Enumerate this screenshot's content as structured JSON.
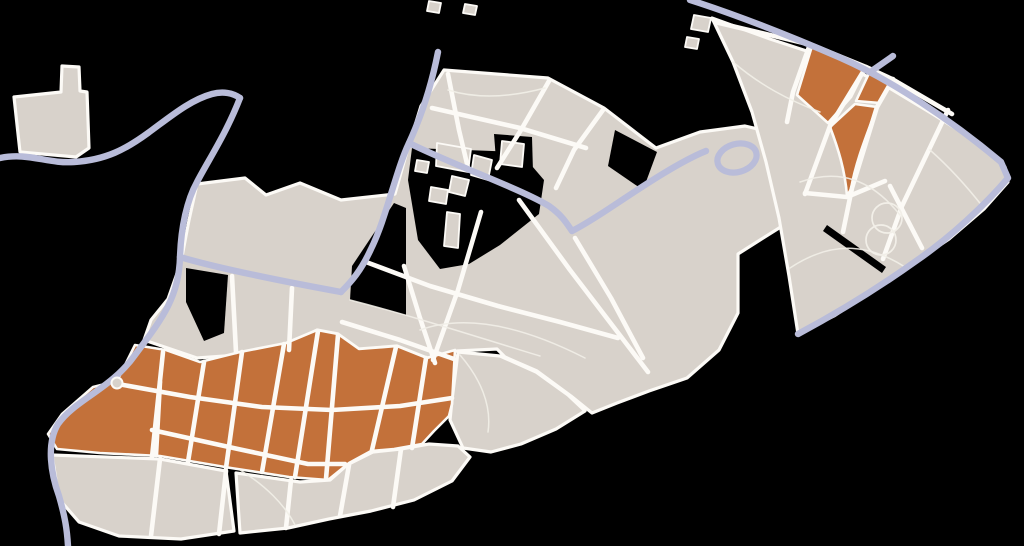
{
  "canvas": {
    "width": 1024,
    "height": 546,
    "background": "#000000"
  },
  "colors": {
    "block": "#d8d2cb",
    "street": "#fcfaf6",
    "water": "#b9bcd9",
    "highlight": "#c3713a",
    "thin_path": "#f2efe8",
    "background": "#000000"
  },
  "layers": [
    {
      "name": "city-blocks",
      "type": "paths",
      "fill": "block",
      "stroke": "street",
      "width": 3.2,
      "interactable": "false",
      "items": [
        {
          "name": "block-top-left-building",
          "d": "M14,97 L61,92 L62,66 L79,67 L80,91 L87,92 L89,148 L76,157 L20,152 Z"
        },
        {
          "name": "block-central-cluster",
          "d": "M444,70 L548,78 L604,108 L656,148 L700,132 L745,126 L788,136 L812,158 L815,186 L795,218 L760,240 L738,254 L738,313 L719,350 L687,378 L649,391 L617,403 L592,413 L571,396 L537,371 L505,357 L497,349 L457,351 L427,358 L397,346 L359,349 L338,334 L317,330 L287,345 L239,355 L197,358 L144,340 L151,320 L168,299 L181,262 L189,220 L197,184 L245,178 L266,195 L300,183 L341,200 L395,194 L408,148 L421,106 Z"
        },
        {
          "name": "block-northeast-cluster",
          "d": "M712,18 L770,39 L831,59 L881,83 L931,113 L976,141 L1005,167 L1008,182 L984,209 L949,239 L909,266 L869,293 L834,316 L798,334 L789,276 L779,218 L766,162 L752,112 L733,62 Z"
        },
        {
          "name": "block-southwest-gray-left",
          "d": "M52,455 L160,459 L226,471 L234,531 L181,539 L119,536 L79,522 L59,499 Z"
        },
        {
          "name": "block-southwest-gray-bottom",
          "d": "M236,473 L300,482 L330,480 L347,465 L373,452 L401,449 L429,444 L458,446 L470,457 L452,481 L414,500 L371,511 L329,519 L288,528 L240,533 Z"
        },
        {
          "name": "block-southwest-gray-right",
          "d": "M458,352 L500,356 L536,372 L568,395 L585,411 L556,429 L521,444 L491,452 L463,448 L450,420 L452,400 Z"
        }
      ]
    },
    {
      "name": "highlight-districts",
      "type": "paths",
      "fill": "highlight",
      "stroke": "street",
      "width": 2.6,
      "interactable": "true",
      "items": [
        {
          "name": "highlight-southwest-district",
          "d": "M93,387 L117,381 L135,345 L166,350 L200,362 L240,352 L286,343 L317,330 L338,334 L359,349 L397,346 L427,358 L455,350 L452,404 L449,416 L434,431 L422,444 L394,449 L371,451 L349,463 L328,480 L289,477 L231,468 L160,456 L100,453 L57,449 L48,434 L62,414 Z"
        },
        {
          "name": "highlight-northeast-parcel-1",
          "d": "M812,46 L866,67 L851,97 L828,123 L797,95 Z"
        },
        {
          "name": "highlight-northeast-parcel-2",
          "d": "M871,69 L893,79 L880,103 L856,101 Z"
        },
        {
          "name": "highlight-northeast-parcel-3",
          "d": "M830,127 L855,104 L877,107 C868,132 856,160 851,189 L847,196 C845,170 838,148 830,127 Z"
        }
      ]
    },
    {
      "name": "park-notches",
      "type": "paths",
      "fill": "background",
      "stroke": "none",
      "width": 0,
      "interactable": "false",
      "items": [
        {
          "name": "notch-canal-pocket",
          "d": "M350,300 L352,266 L394,203 L406,208 L406,315 Z"
        },
        {
          "name": "notch-park-main",
          "d": "M412,148 L520,152 L544,180 L539,214 L500,245 L469,264 L440,269 L418,240 L408,180 Z"
        },
        {
          "name": "notch-round-building",
          "d": "M494,134 L532,137 L533,172 L497,173 Z"
        },
        {
          "name": "notch-east-wedge",
          "d": "M615,130 L657,152 L643,190 L608,166 Z"
        },
        {
          "name": "notch-west",
          "d": "M186,268 L228,275 L224,333 L204,341 L186,302 Z"
        },
        {
          "name": "notch-northeast-slit",
          "d": "M827,225 L886,267 L882,273 L823,231 Z"
        }
      ]
    },
    {
      "name": "buildings",
      "type": "paths",
      "fill": "block",
      "stroke": "street",
      "width": 1.8,
      "interactable": "false",
      "items": [
        {
          "name": "building-footprint",
          "d": "M437,143 L471,149 L468,172 L436,166 Z"
        },
        {
          "name": "building-footprint",
          "d": "M474,155 L492,160 L488,180 L471,175 Z"
        },
        {
          "name": "building-footprint",
          "d": "M452,176 L469,180 L465,196 L449,192 Z"
        },
        {
          "name": "building-footprint",
          "d": "M431,187 L448,190 L446,204 L429,201 Z"
        },
        {
          "name": "building-footprint-pill",
          "d": "M447,212 L460,214 L458,248 L444,246 Z"
        },
        {
          "name": "building-footprint-rounded",
          "d": "M502,141 L524,144 L522,167 L500,164 Z"
        },
        {
          "name": "building-footprint",
          "d": "M417,160 L429,162 L427,173 L415,171 Z"
        },
        {
          "name": "building-footprint",
          "d": "M429,1 L441,3 L439,13 L427,11 Z"
        },
        {
          "name": "building-footprint",
          "d": "M465,4 L477,6 L475,15 L463,13 Z"
        },
        {
          "name": "building-footprint",
          "d": "M694,15 L711,18 L708,32 L691,29 Z"
        },
        {
          "name": "building-footprint",
          "d": "M687,37 L699,39 L697,49 L685,47 Z"
        }
      ]
    },
    {
      "name": "streets-major",
      "type": "strokes",
      "stroke": "street",
      "width": 4.6,
      "interactable": "false",
      "items": [
        {
          "name": "street",
          "d": "M448,74 L459,130 L468,168"
        },
        {
          "name": "street",
          "d": "M549,81 L521,130 L497,168"
        },
        {
          "name": "street",
          "d": "M603,110 L574,150 L556,188"
        },
        {
          "name": "street",
          "d": "M432,108 L520,128 L586,148"
        },
        {
          "name": "street",
          "d": "M404,266 L420,318 L435,363"
        },
        {
          "name": "street",
          "d": "M481,212 L458,290 L433,360"
        },
        {
          "name": "street",
          "d": "M519,200 L570,270 L622,338 L648,372"
        },
        {
          "name": "street",
          "d": "M575,238 L611,298 L643,358"
        },
        {
          "name": "street",
          "d": "M342,322 L400,340 L454,359"
        },
        {
          "name": "street",
          "d": "M366,262 L430,286 L498,306 L560,322 L618,338"
        },
        {
          "name": "street",
          "d": "M232,276 L236,352"
        },
        {
          "name": "street",
          "d": "M292,288 L289,350"
        },
        {
          "name": "street",
          "d": "M715,22 L812,45 L866,67 L892,79 L952,114"
        },
        {
          "name": "street",
          "d": "M810,44 L793,92 L787,122"
        },
        {
          "name": "street",
          "d": "M866,67 L830,126 L805,194"
        },
        {
          "name": "street",
          "d": "M893,79 L877,107 L852,188 L843,232"
        },
        {
          "name": "street",
          "d": "M805,193 L847,197 L885,181"
        },
        {
          "name": "street",
          "d": "M948,110 L902,206 L883,259"
        },
        {
          "name": "street",
          "d": "M890,186 L922,248"
        },
        {
          "name": "street",
          "d": "M163,352 L152,457"
        },
        {
          "name": "street",
          "d": "M204,362 L188,462"
        },
        {
          "name": "street",
          "d": "M242,352 L226,468"
        },
        {
          "name": "street",
          "d": "M284,344 L262,472"
        },
        {
          "name": "street",
          "d": "M318,331 L295,477"
        },
        {
          "name": "street",
          "d": "M338,335 L326,479"
        },
        {
          "name": "street",
          "d": "M396,347 L372,450"
        },
        {
          "name": "street",
          "d": "M426,358 L412,448"
        },
        {
          "name": "street",
          "d": "M118,384 L190,397 L262,407 L332,410 L400,406 L452,398"
        },
        {
          "name": "street",
          "d": "M152,430 L238,449 L308,464 L345,464"
        },
        {
          "name": "street",
          "d": "M160,382 L156,455"
        },
        {
          "name": "street",
          "d": "M160,459 L151,536"
        },
        {
          "name": "street",
          "d": "M226,471 L219,534"
        },
        {
          "name": "street",
          "d": "M291,480 L286,528"
        },
        {
          "name": "street",
          "d": "M349,465 L340,516"
        },
        {
          "name": "street",
          "d": "M401,449 L393,507"
        }
      ]
    },
    {
      "name": "paths-minor",
      "type": "strokes",
      "stroke": "thin_path",
      "width": 1.5,
      "opacity": 0.9,
      "interactable": "false",
      "items": [
        {
          "name": "footpath",
          "d": "M800,182 C840,168 872,180 900,215"
        },
        {
          "name": "footpath",
          "d": "M790,268 C835,238 872,246 905,267"
        },
        {
          "name": "footpath",
          "d": "M930,150 C955,172 972,193 983,207"
        },
        {
          "name": "footpath",
          "d": "M733,62 C760,85 788,100 820,112"
        },
        {
          "name": "footpath",
          "d": "M420,330 C470,312 530,330 585,358"
        },
        {
          "name": "footpath",
          "d": "M350,300 C420,318 480,338 540,356"
        },
        {
          "name": "footpath",
          "d": "M448,90 C480,100 515,96 545,88"
        },
        {
          "name": "footpath",
          "d": "M240,470 C265,485 285,505 295,525"
        },
        {
          "name": "footpath",
          "d": "M460,355 C480,378 492,405 488,432"
        }
      ]
    },
    {
      "name": "park-loops",
      "type": "ellipses",
      "fill": "none",
      "stroke": "thin_path",
      "width": 1.7,
      "interactable": "false",
      "items": [
        {
          "name": "park-loop-circle",
          "cx": 887,
          "cy": 218,
          "rx": 15,
          "ry": 15,
          "rot": 0
        },
        {
          "name": "park-loop-circle",
          "cx": 881,
          "cy": 240,
          "rx": 15,
          "ry": 15,
          "rot": 0
        }
      ]
    },
    {
      "name": "waterways",
      "type": "strokes",
      "stroke": "water",
      "width": 6.4,
      "interactable": "false",
      "items": [
        {
          "name": "waterway-northwest",
          "d": "M0,158 C28,152 48,164 74,162 C106,160 126,149 148,133 C170,117 190,100 212,94 C223,91 233,93 240,98"
        },
        {
          "name": "waterway-main-canal",
          "d": "M240,98 C226,134 209,159 197,182 C187,200 181,227 180,257 C179,298 161,320 135,355 C111,389 76,399 58,424 C46,444 51,474 59,496 C65,517 67,529 68,546"
        },
        {
          "name": "waterway-east-branch",
          "d": "M180,257 C221,269 281,281 341,292"
        },
        {
          "name": "waterway-north-canal",
          "d": "M438,52 C431,88 420,119 409,143 C396,170 386,219 371,249 C361,271 351,282 341,292"
        },
        {
          "name": "waterway-central-canal",
          "d": "M409,143 C451,164 521,189 549,206 C563,216 567,224 572,231 C586,224 601,214 616,204 C646,184 681,161 706,151"
        },
        {
          "name": "waterway-riverside-edge",
          "d": "M690,0 C740,16 790,36 841,58 C891,80 951,120 1001,162 L1008,178 C986,204 951,237 916,261 C881,286 841,311 798,334"
        },
        {
          "name": "waterway-stub",
          "d": "M893,56 L873,70"
        }
      ]
    },
    {
      "name": "water-ring",
      "type": "ellipses",
      "fill": "none",
      "stroke": "water",
      "width": 6.2,
      "interactable": "false",
      "items": [
        {
          "name": "moat-ring",
          "cx": 737,
          "cy": 158,
          "rx": 20,
          "ry": 14,
          "rot": -16
        }
      ]
    },
    {
      "name": "mini-roundabout",
      "type": "ellipses",
      "fill": "block",
      "stroke": "street",
      "width": 2,
      "interactable": "false",
      "items": [
        {
          "name": "roundabout",
          "cx": 117,
          "cy": 383,
          "rx": 5.5,
          "ry": 5.5,
          "rot": 0
        }
      ]
    }
  ]
}
